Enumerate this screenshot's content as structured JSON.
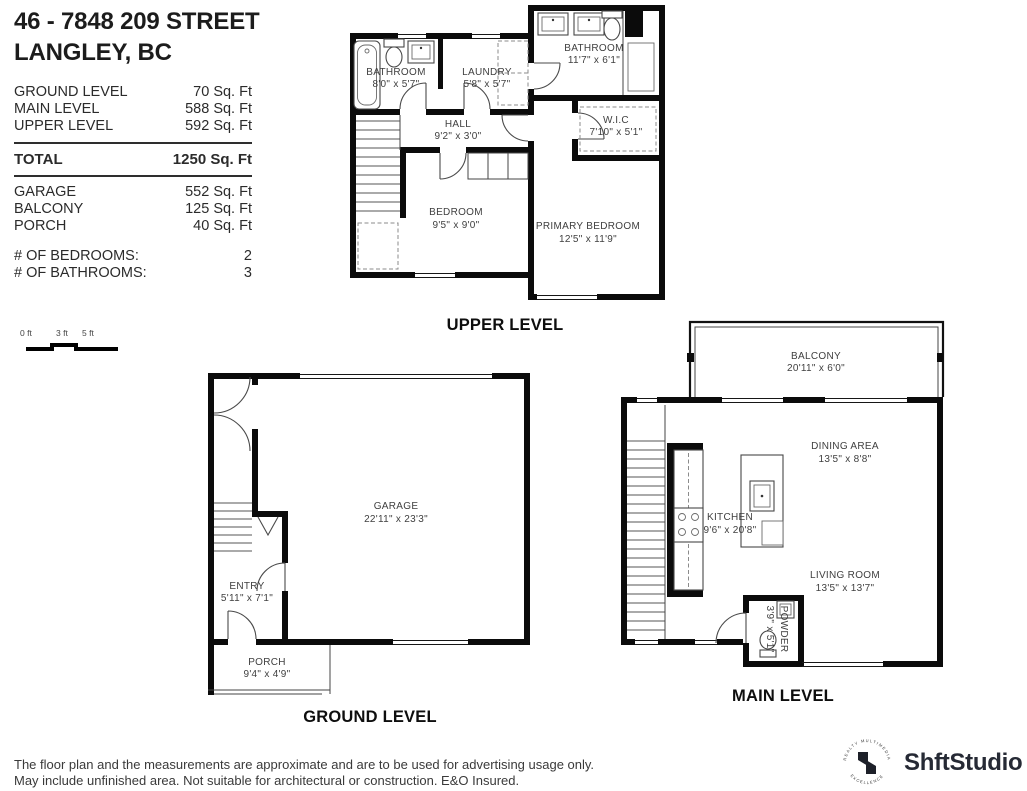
{
  "header": {
    "line1": "46 - 7848 209 STREET",
    "line2": "LANGLEY, BC"
  },
  "areas": {
    "levels": [
      {
        "label": "GROUND LEVEL",
        "value": "70 Sq. Ft"
      },
      {
        "label": "MAIN LEVEL",
        "value": "588 Sq. Ft"
      },
      {
        "label": "UPPER LEVEL",
        "value": "592 Sq. Ft"
      }
    ],
    "total": {
      "label": "TOTAL",
      "value": "1250 Sq. Ft"
    },
    "extras": [
      {
        "label": "GARAGE",
        "value": "552 Sq. Ft"
      },
      {
        "label": "BALCONY",
        "value": "125 Sq. Ft"
      },
      {
        "label": "PORCH",
        "value": "40 Sq. Ft"
      }
    ],
    "counts": [
      {
        "label": "# OF BEDROOMS:",
        "value": "2"
      },
      {
        "label": "# OF BATHROOMS:",
        "value": "3"
      }
    ]
  },
  "scale_bar": {
    "labels": [
      "0 ft",
      "3 ft",
      "5 ft"
    ]
  },
  "plans": {
    "upper": {
      "title": "UPPER LEVEL",
      "rooms": {
        "bathroom1": {
          "name": "BATHROOM",
          "dims": "8'0\" x 5'7\""
        },
        "laundry": {
          "name": "LAUNDRY",
          "dims": "5'8\" x 5'7\""
        },
        "bathroom2": {
          "name": "BATHROOM",
          "dims": "11'7\" x 6'1\""
        },
        "hall": {
          "name": "HALL",
          "dims": "9'2\" x 3'0\""
        },
        "wic": {
          "name": "W.I.C",
          "dims": "7'10\" x 5'1\""
        },
        "bedroom": {
          "name": "BEDROOM",
          "dims": "9'5\" x 9'0\""
        },
        "primary": {
          "name": "PRIMARY BEDROOM",
          "dims": "12'5\" x 11'9\""
        }
      }
    },
    "ground": {
      "title": "GROUND LEVEL",
      "rooms": {
        "garage": {
          "name": "GARAGE",
          "dims": "22'11\" x 23'3\""
        },
        "entry": {
          "name": "ENTRY",
          "dims": "5'11\" x 7'1\""
        },
        "porch": {
          "name": "PORCH",
          "dims": "9'4\" x 4'9\""
        }
      }
    },
    "main": {
      "title": "MAIN LEVEL",
      "rooms": {
        "balcony": {
          "name": "BALCONY",
          "dims": "20'11\" x 6'0\""
        },
        "dining": {
          "name": "DINING AREA",
          "dims": "13'5\" x 8'8\""
        },
        "kitchen": {
          "name": "KITCHEN",
          "dims": "9'6\" x 20'8\""
        },
        "living": {
          "name": "LIVING ROOM",
          "dims": "13'5\" x 13'7\""
        },
        "powder": {
          "name": "POWDER",
          "dims": "3'9\" x 5'1\""
        }
      }
    }
  },
  "footer": {
    "line1": "The floor plan and the measurements are approximate and are to be used for advertising usage only.",
    "line2": "May include unfinished area. Not suitable for architectural or construction. E&O Insured.",
    "brand": "ShftStudio",
    "badge_top": "REALTY MULTIMEDIA",
    "badge_bottom": "EXCELLENCE"
  }
}
